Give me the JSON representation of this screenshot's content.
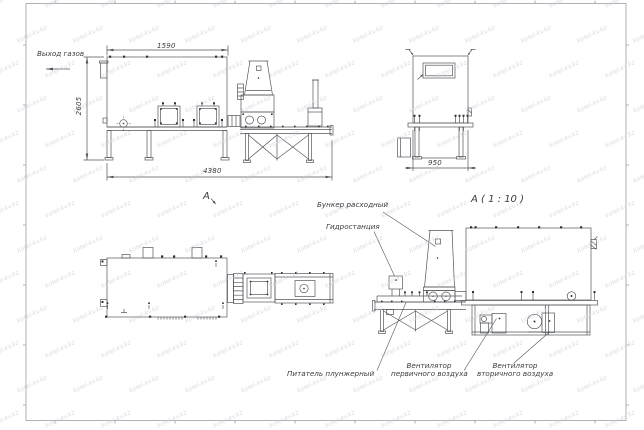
{
  "drawing": {
    "labels": {
      "gas_outlet": "Выход газов"
    },
    "dims": {
      "front_top": "1590",
      "front_height": "2605",
      "front_length": "4380",
      "side_width": "950"
    },
    "view_labels": {
      "front_view_mark": "А",
      "side_view_scale": "А ( 1 : 10 )"
    },
    "annotations": {
      "feed_hopper": "Бункер расходный",
      "hydraulic_station": "Гидростанция",
      "plunger_feeder": "Питатель плунжерный",
      "primary_fan_line1": "Вентилятор",
      "primary_fan_line2": "первичного воздуха",
      "secondary_fan_line1": "Вентилятор",
      "secondary_fan_line2": "вторичного воздуха"
    },
    "watermark": {
      "text": "kotel-kv.kz",
      "color": "#c9ccd4"
    },
    "colors": {
      "line": "#53565b",
      "bolt_fill": "#2e3033",
      "frame": "#9aa0a6",
      "text": "#3a3c40",
      "background": "#ffffff"
    }
  }
}
